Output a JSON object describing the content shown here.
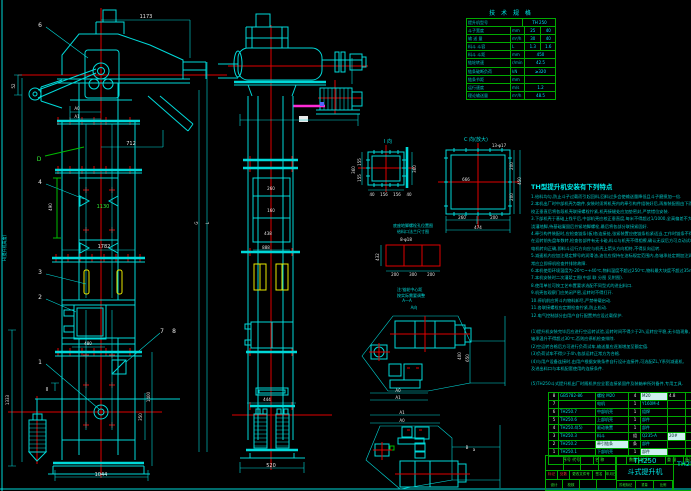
{
  "left_view": {
    "balloons": {
      "b1": "1",
      "b2": "2",
      "b3": "3",
      "b4": "4",
      "b6": "6",
      "b7": "7",
      "b8": "8"
    },
    "labels": {
      "d": "D",
      "section": "II",
      "height": "H(提升机高度)",
      "l": "L",
      "g": "G"
    },
    "dims": {
      "top": "1173",
      "chute": "712",
      "a0": "A0",
      "a1": "A1",
      "left_small": "52",
      "mid": "490",
      "green_mid": "1130",
      "width_mid": "1782",
      "boot_top": "480",
      "bottom": "1044",
      "left_tall": "1333",
      "right_a": "350",
      "right_b": "1400"
    }
  },
  "middle_view": {
    "dims": {
      "d1": "260",
      "d2": "160",
      "d3": "438",
      "d4": "888",
      "d5": "444",
      "d6": "520"
    }
  },
  "detail_i": {
    "title": "I 向",
    "dims": {
      "b1": "40",
      "b2": "156",
      "b3": "156",
      "b4": "40",
      "l1": "155",
      "l2": "155",
      "l3": "360",
      "r1": "360"
    }
  },
  "detail_c": {
    "title": "C 向(放大)",
    "note": "13-φ17",
    "inner": "666",
    "caption": "底座地脚螺栓孔位置图",
    "dims": {
      "b1": "260",
      "b2": "200",
      "b3": "474",
      "r1": "200",
      "r2": "200",
      "r3": "450"
    }
  },
  "feed_detail": {
    "caption": "给料口法兰尺寸图",
    "note": "8-φ18",
    "remark1": "注:链轮中心距",
    "remark2": "按实际需要调整",
    "label_aa": "A—A",
    "label_av": "A向",
    "dims": {
      "b1": "200",
      "b2": "300",
      "b3": "200",
      "l1": "432"
    }
  },
  "plan_top": {
    "dims": {
      "a0": "A0",
      "a1": "A1",
      "r1": "400",
      "r2": "650"
    }
  },
  "plan_bottom": {
    "dims": {
      "a1": "A1",
      "a0": "A0",
      "b": "B",
      "a": "a"
    }
  },
  "tech_table": {
    "title": "技 术 规 格",
    "rows": [
      {
        "c0": "提升机型号",
        "c1": "TH 250",
        "c2": "",
        "c3": ""
      },
      {
        "c0": "斗子宽度",
        "c1": "mm",
        "c2": "25",
        "c3": "40"
      },
      {
        "c0": "输 送 量",
        "c1": "m³/h",
        "c2": "30",
        "c3": "40"
      },
      {
        "c0": "料斗 斗容",
        "c1": "L",
        "c2": "1.3",
        "c3": "1.6"
      },
      {
        "c0": "料斗 斗距",
        "c1": "mm",
        "c2": "450",
        "c3": ""
      },
      {
        "c0": "链轮转速",
        "c1": "r/min",
        "c2": "42.5",
        "c3": ""
      },
      {
        "c0": "链条破断负荷",
        "c1": "kN",
        "c2": "≥320",
        "c3": ""
      },
      {
        "c0": "链条节距",
        "c1": "mm",
        "c2": "",
        "c3": ""
      },
      {
        "c0": "运行速度",
        "c1": "m/s",
        "c2": "1.2",
        "c3": ""
      },
      {
        "c0": "理论输送量",
        "c1": "m³/h",
        "c2": "48.5",
        "c3": ""
      }
    ]
  },
  "notes": {
    "heading": "TH型提升机安装有下列特点",
    "linesA": [
      "1.给料均匀,防止斗子过载而引起回料,回料过多会使输送量降低且斗子磨损加一倍.",
      "2.本机出厂时中部机壳为散件,安装时须将机壳内的牵引构件组装好后,再按装配图由下而上顺序安装,",
      "  校正垂直后将各段机壳联接螺栓拧紧,机壳接缝处应加垫密封,严禁错位安装.",
      "3.下部机壳于基础上找平后,中部机壳应校正垂直度,每米不得超过1/1000,全高偏差不大于8mm,方可",
      "  浇灌地脚,待基础凝固后拧紧地脚螺栓,最后将各部分联接紧固好.",
      "4.牵引构件装配时,应检查链条(板)各连接处,张紧装置应使链条松紧适当,工作时链条不得有跳动现象,",
      "  在运转前先盘车数转,检查各部件有无卡碰,料斗与机壳不得相擦,确认无误后方可点动试车,并注意",
      "  电机转向正确,即料斗运行方向应与机壳上箭头方向相符,不得反向运转.",
      "5.减速机内应加注规定牌号的润滑油,油位应保持在油标规定范围内,各轴承处定期加注润滑脂,发现异",
      "  常应立即停机检查并排除故障.",
      "6.本机使用环境温度为-20℃~+40℃,物料温度不超过250℃,物料最大块度不超过35mm.",
      "7.本机安装时二次灌浆工图(中部 联 分图 见附图).",
      "8.使用单位可按工艺布置要求选配不同型式的进出料口.",
      "9.机壳各观察门应关闭严密,运转时不得打开.",
      "10.停机前应将斗内物料卸尽,严禁带载启动.",
      "11.各联接螺栓应定期检查拧紧,防止松动.",
      "12.电气控制部分由用户自行配置并应设过载保护."
    ],
    "linesB": [
      "(1)提升机安装完毕后应进行空运转试验,运转时间不得少于2h,运转应平稳,无卡链现象,",
      "  轴承温升不得超过30℃,否则应停机检查排除.",
      "(2)空运转合格后方可进行负荷试车,输送量应逐渐增加至额定值.",
      "(3)负荷试车不得少于4h,各部运转正常方为合格.",
      "(4)与用户设备连接时,由用户根据安装条件自行设计连接件,可选配ZL,Y系列减速机,",
      "  及进出料口与本机配套使用的连接条件."
    ],
    "linesC": [
      "(5)TH250斗式提升机出厂时随机供应全套连接紧固件及装箱单所列备件,专用工具."
    ]
  },
  "bom": {
    "rows": [
      {
        "no": "8",
        "code": "GB5782-86",
        "name": "螺栓 M20",
        "qty": "4",
        "mat": "M20",
        "wt": "4.8",
        "note": ""
      },
      {
        "no": "7",
        "code": "",
        "name": "电机",
        "qty": "1",
        "mat": "Y160M-4",
        "wt": "",
        "note": ""
      },
      {
        "no": "6",
        "code": "TH250.7",
        "name": "中部机壳",
        "qty": "1",
        "mat": "组焊",
        "wt": "",
        "note": ""
      },
      {
        "no": "5",
        "code": "TH250.6",
        "name": "上部机壳",
        "qty": "1",
        "mat": "部件",
        "wt": "",
        "note": ""
      },
      {
        "no": "4",
        "code": "TH250.4(5)",
        "name": "驱动装置",
        "qty": "1",
        "mat": "部件",
        "wt": "",
        "note": ""
      },
      {
        "no": "3",
        "code": "TH250.3",
        "name": "料斗",
        "qty": "组",
        "mat": "Q235-A",
        "wt": "20#",
        "note": ""
      },
      {
        "no": "2",
        "code": "TH250.2",
        "name": "牵引链条",
        "qty": "条",
        "mat": "部件",
        "wt": "",
        "note": ""
      },
      {
        "no": "1",
        "code": "TH250.1",
        "name": "下部机壳",
        "qty": "1",
        "mat": "部件",
        "wt": "",
        "note": ""
      }
    ],
    "header": {
      "c0": "序号 代号",
      "c1": "名 称",
      "c2": "数量",
      "c3": "材 料",
      "c4": "重 量",
      "c5": "备注"
    }
  },
  "title_block": {
    "model": "TH250",
    "product": "斗式提升机",
    "code": "TH250.0",
    "marks": {
      "m1": "标记",
      "m2": "处数",
      "m3": "更改文件号",
      "m4": "签名",
      "m5": "年月日"
    },
    "signs": {
      "s1": "设计",
      "s2": "校核"
    },
    "cells": {
      "c1": "阶段标记",
      "c2": "重量",
      "c3": "比例"
    }
  }
}
